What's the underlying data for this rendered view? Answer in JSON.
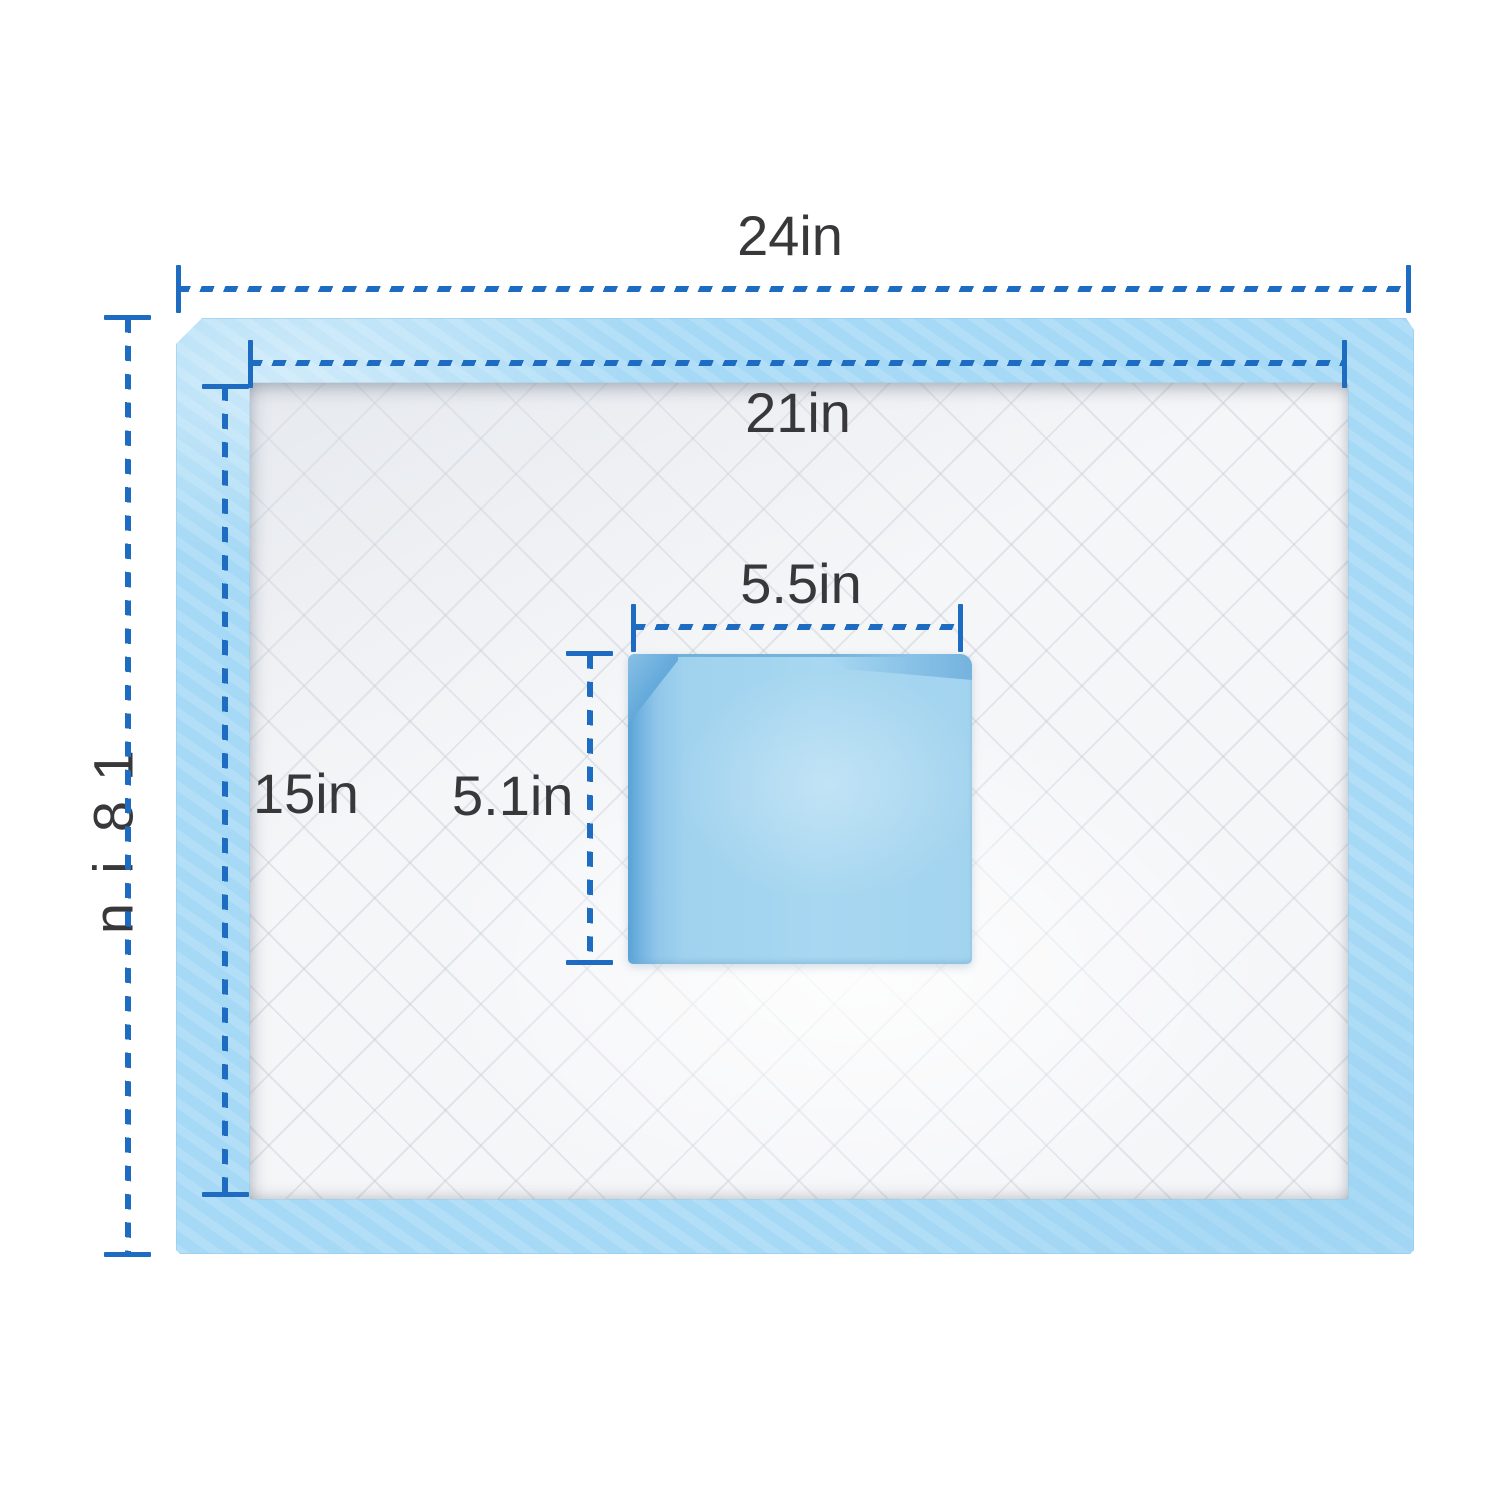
{
  "diagram": {
    "dimension_labels": {
      "outer_width": "24in",
      "outer_height": "18in",
      "core_width": "21in",
      "core_height": "15in",
      "folded_width": "5.5in",
      "folded_height": "5.1in"
    },
    "colors": {
      "dimension_line_blue": "#1d6cc2",
      "label_text": "#38383b",
      "backing_sheet_blue": "#a9dbf6",
      "absorbent_core_white": "#f5f6f8",
      "folded_pad_blue": "#a3d4ef",
      "folded_pad_edge_blue": "#57a3d7"
    }
  }
}
